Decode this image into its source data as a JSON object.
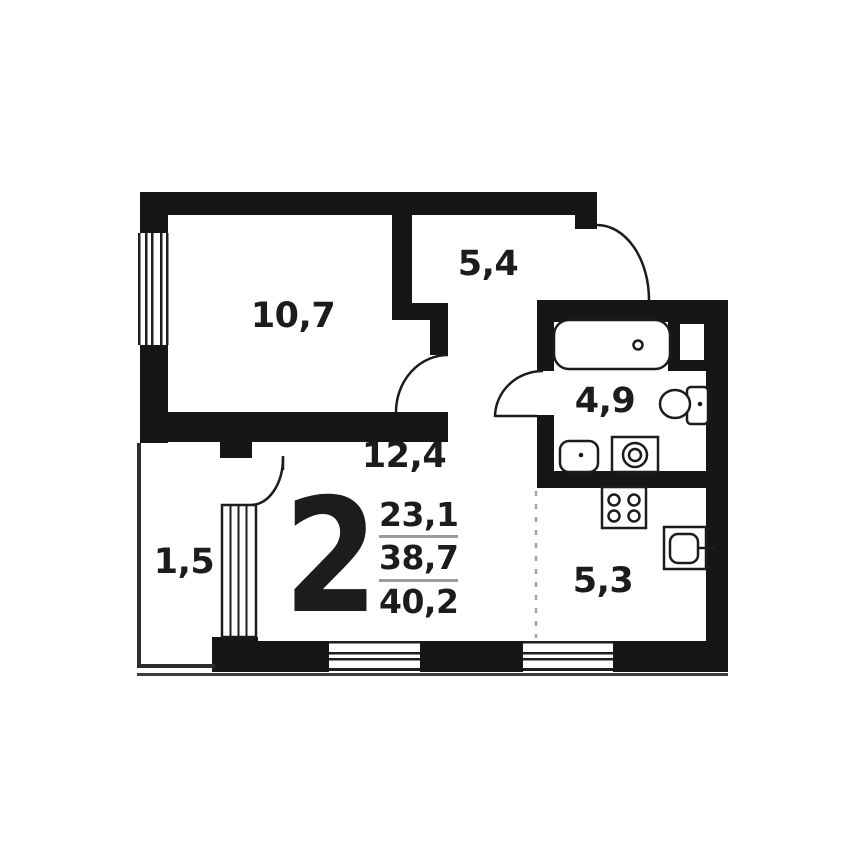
{
  "plan": {
    "room_labels": {
      "bedroom": "10,7",
      "hallway": "5,4",
      "bathroom": "4,9",
      "living_room": "12,4",
      "wardrobe": "1,5",
      "kitchen": "5,3"
    },
    "summary": {
      "rooms_count": "2",
      "stacked_values": [
        "23,1",
        "38,7",
        "40,2"
      ]
    },
    "fixtures": [
      "bathtub",
      "toilet",
      "sink",
      "washing-machine",
      "stove",
      "kitchen-sink"
    ],
    "colors": {
      "wall": "#161616",
      "fixture_line": "#1c1c1c",
      "fraction_line": "#9c9c9c",
      "dashed_divider": "#a3a3a3"
    }
  }
}
